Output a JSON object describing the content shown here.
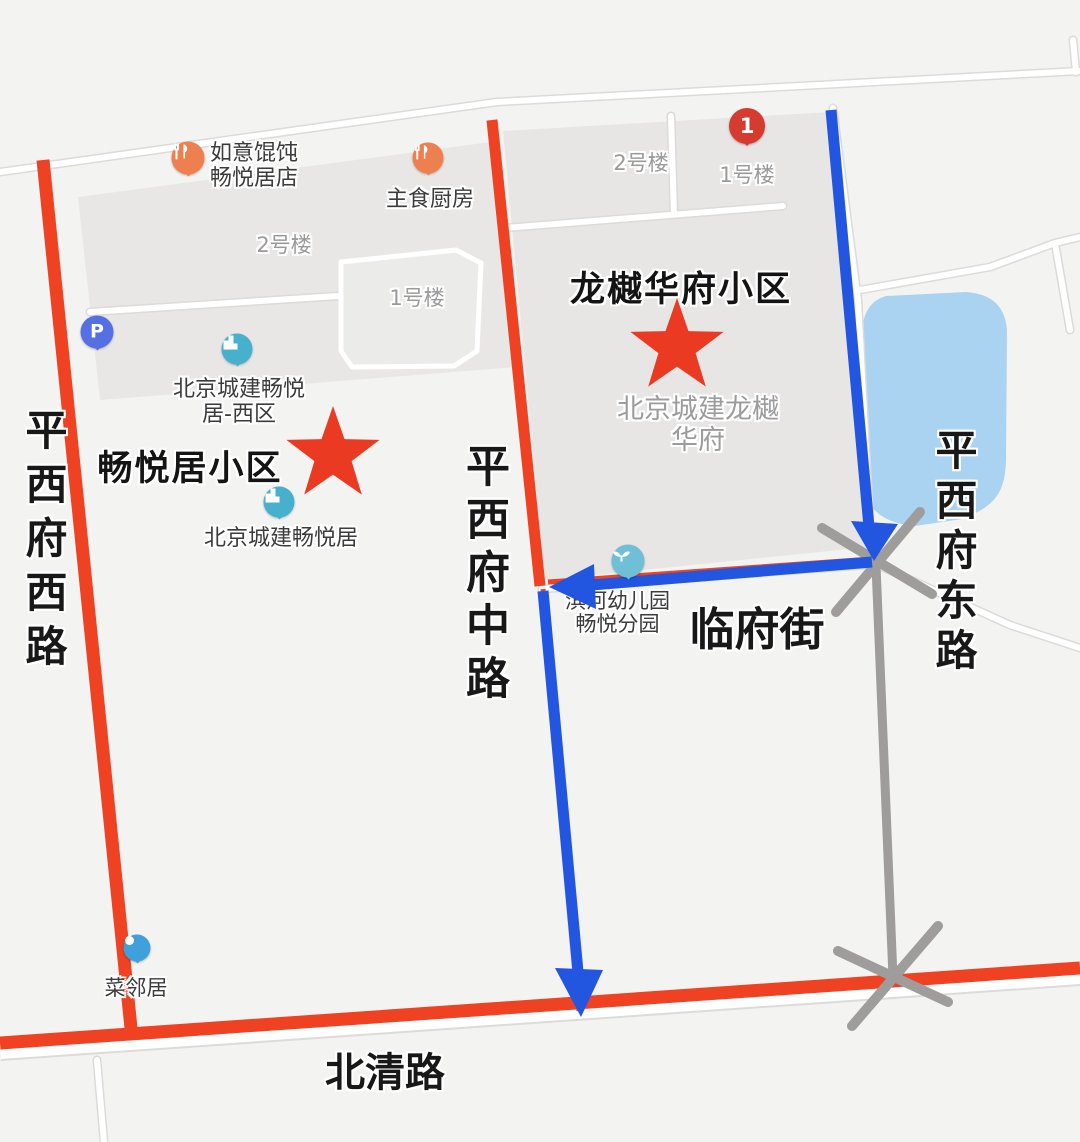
{
  "colors": {
    "route_blue": "#2255e0",
    "road_red": "#ee4223",
    "closed_road_gray": "#9e9d9c",
    "water_blue": "#a9d3f1",
    "star_red": "#ea3b22",
    "compound_gray": "#e8e6e5",
    "white_road": "#ffffff"
  },
  "roads": {
    "west": {
      "label": "平西府西路"
    },
    "middle": {
      "label": "平西府中路"
    },
    "east": {
      "label": "平西府东路"
    },
    "beiqing": {
      "label": "北清路"
    },
    "linfu": {
      "label": "临府街"
    }
  },
  "communities": {
    "changyueju": {
      "label": "畅悦居小区"
    },
    "longyue": {
      "label": "龙樾华府小区"
    }
  },
  "buildings": {
    "west_b2": "2号楼",
    "west_b1": "1号楼",
    "east_b2": "2号楼",
    "east_b1": "1号楼"
  },
  "markers": {
    "numbered_pin_label": "1"
  },
  "pois": {
    "ruyi": {
      "lines": [
        "如意馄饨",
        "畅悦居店"
      ]
    },
    "zhushi": {
      "label": "主食厨房"
    },
    "parking": {
      "glyph": "P"
    },
    "xiqu": {
      "lines": [
        "北京城建畅悦",
        "居-西区"
      ]
    },
    "changyueju": {
      "label": "北京城建畅悦居"
    },
    "cailinju": {
      "label": "菜邻居"
    },
    "kindergarten": {
      "lines": [
        "滨河幼儿园",
        "畅悦分园"
      ]
    }
  },
  "area_labels": {
    "longyue_dev": {
      "lines": [
        "北京城建龙樾",
        "华府"
      ]
    }
  }
}
